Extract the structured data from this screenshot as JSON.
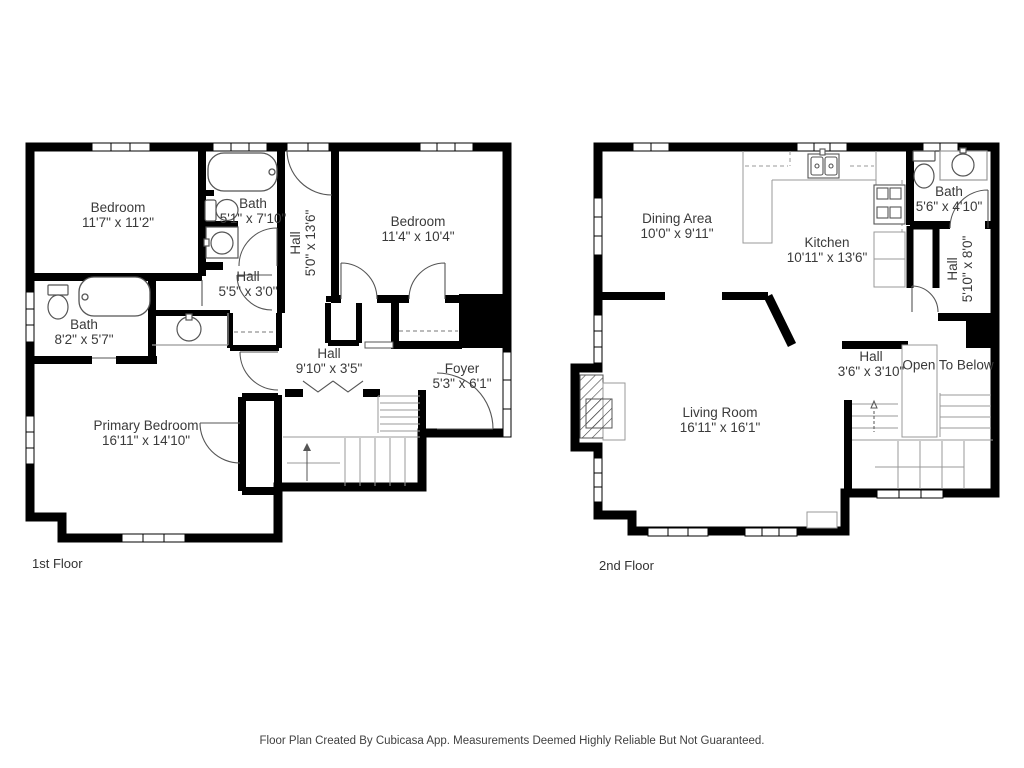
{
  "page": {
    "background": "#ffffff"
  },
  "colors": {
    "wall": "#000000",
    "fixture_line": "#555555",
    "light_line": "#999999",
    "label_text": "#3a3a3a",
    "footer_text": "#3f3f3f"
  },
  "floors": [
    {
      "caption": "1st Floor",
      "rooms": [
        {
          "name": "Bedroom",
          "dims": "11'7\" x 11'2\""
        },
        {
          "name": "Bath",
          "dims": "5'1\" x 7'10\""
        },
        {
          "name": "Hall",
          "dims": "5'0\" x 13'6\""
        },
        {
          "name": "Bedroom",
          "dims": "11'4\" x 10'4\""
        },
        {
          "name": "Hall",
          "dims": "5'5\" x 3'0\""
        },
        {
          "name": "Bath",
          "dims": "8'2\" x 5'7\""
        },
        {
          "name": "Hall",
          "dims": "9'10\" x 3'5\""
        },
        {
          "name": "Foyer",
          "dims": "5'3\" x 6'1\""
        },
        {
          "name": "Primary Bedroom",
          "dims": "16'11\" x 14'10\""
        }
      ]
    },
    {
      "caption": "2nd Floor",
      "rooms": [
        {
          "name": "Dining Area",
          "dims": "10'0\" x 9'11\""
        },
        {
          "name": "Kitchen",
          "dims": "10'11\" x 13'6\""
        },
        {
          "name": "Bath",
          "dims": "5'6\" x 4'10\""
        },
        {
          "name": "Hall",
          "dims": "5'10\" x 8'0\""
        },
        {
          "name": "Hall",
          "dims": "3'6\" x 3'10\""
        },
        {
          "name": "Open To Below",
          "dims": ""
        },
        {
          "name": "Living Room",
          "dims": "16'11\" x 16'1\""
        }
      ]
    }
  ],
  "footer": {
    "disclaimer": "Floor Plan Created By Cubicasa App. Measurements Deemed Highly Reliable But Not Guaranteed."
  }
}
